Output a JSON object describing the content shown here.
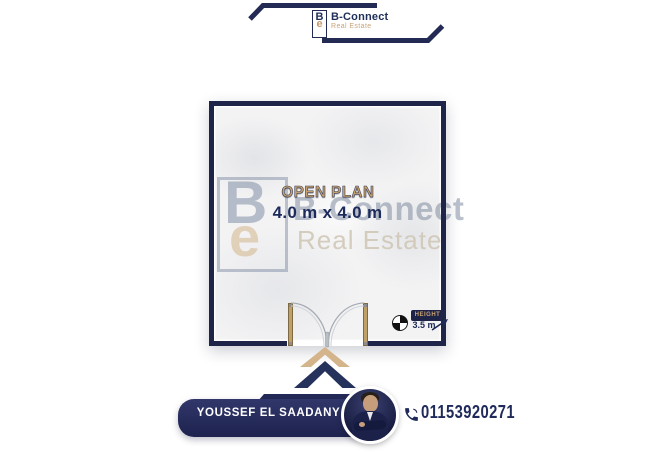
{
  "brand": {
    "name": "B-Connect",
    "tagline": "Real Estate",
    "monogram_top": "B",
    "monogram_bottom": "e"
  },
  "watermark": {
    "monogram_top": "B",
    "monogram_bottom": "e",
    "name": "B-Connect",
    "tagline": "Real Estate"
  },
  "floor_plan": {
    "room_label": "OPEN PLAN",
    "room_dimensions": "4.0 m x 4.0 m",
    "height_label": "HEIGHT",
    "height_value": "3.5 m"
  },
  "footer": {
    "agent_name": "YOUSSEF EL SAADANY",
    "phone_number": "01153920271"
  },
  "icons": {
    "phone": "phone-icon",
    "level_datum": "level-datum-icon",
    "chevron": "chevron-up-icon",
    "door": "double-door-swing"
  },
  "colors": {
    "navy": "#232a54",
    "wall_navy": "#1f2449",
    "tan": "#c9a36f",
    "banner_navy": "#242a58",
    "floor": "#f3f3f4"
  }
}
